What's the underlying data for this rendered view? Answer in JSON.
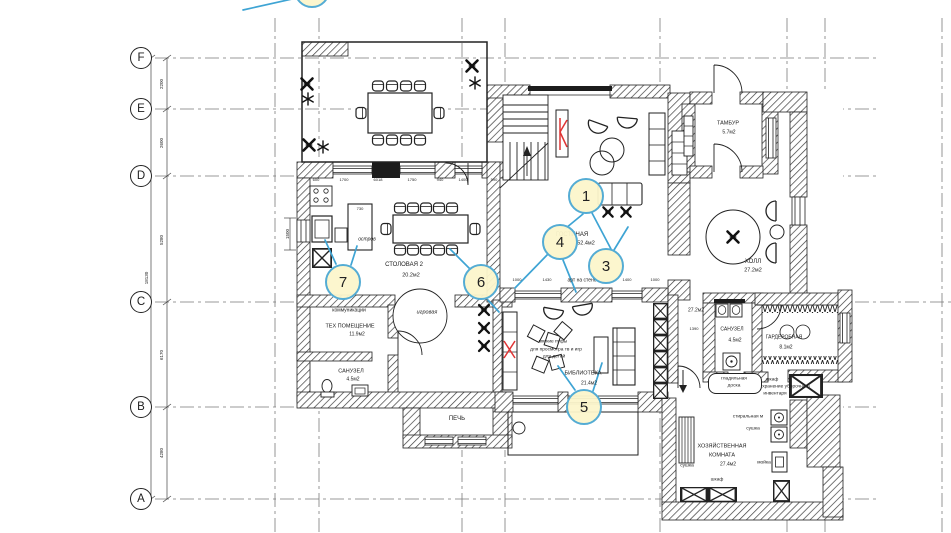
{
  "colors": {
    "leader": "#3EA4D4",
    "marker_fill": "#FCF5CB",
    "marker_border": "#54ACD4",
    "red_accent": "#E03434",
    "wall": "#222222"
  },
  "grid": {
    "bubbles": [
      "F",
      "E",
      "D",
      "C",
      "B",
      "A"
    ]
  },
  "dims": {
    "left": [
      "2200",
      "2600",
      "5280",
      "6170",
      "4280"
    ],
    "left_total": "18130",
    "kitchen_top": [
      "600",
      "1700",
      "6018",
      "1750",
      "940",
      "1400",
      "590"
    ],
    "living_bottom": [
      "1000",
      "1430",
      "1400",
      "1000"
    ],
    "island_width": "730",
    "stair_width": "1500",
    "hall_width": "1390"
  },
  "markers": {
    "m1": "1",
    "m2": "2",
    "m3": "3",
    "m4": "4",
    "m5": "5",
    "m6": "6",
    "m7": "7"
  },
  "rooms": {
    "dining2": {
      "name": "СТОЛОВАЯ 2",
      "area": "20.2м2"
    },
    "tech": {
      "name": "ТЕХ ПОМЕЩЕНИЕ",
      "area": "11.9м2"
    },
    "bath1": {
      "name": "САНУЗЕЛ",
      "area": "4.5м2"
    },
    "living": {
      "name": "ГОСТИНАЯ",
      "area": "52.4м2"
    },
    "hall": {
      "name": "ХОЛЛ",
      "area": "27.2м2",
      "area2": "27.2м2"
    },
    "tambour": {
      "name": "ТАМБУР",
      "area": "5.7м2"
    },
    "bath2": {
      "name": "САНУЗЕЛ",
      "area": "4.5м2"
    },
    "wardrobe": {
      "name": "ГАРДЕРОБНАЯ",
      "area": "8.1м2"
    },
    "library": {
      "name": "БИБЛИОТЕКА",
      "area": "21.4м2"
    },
    "utility": {
      "name1": "ХОЗЯЙСТВЕННАЯ",
      "name2": "КОМНАТА",
      "area": "27.4м2"
    },
    "stove": {
      "name": "ПЕЧЬ"
    },
    "playzone": {
      "name": "игровая"
    }
  },
  "annotations": {
    "communications": "коммуникации",
    "island": "остров",
    "art_wall": "арт на стене",
    "poufs1": "мягкие пуфы",
    "poufs2": "для просмотра тв и игр",
    "poufs3": "для детей",
    "ironing1": "гладильная",
    "ironing2": "доска",
    "closet1": "шкаф",
    "closet2": "хранение уборочного",
    "closet3": "инвентаря",
    "washer": "стиральная м",
    "dryer": "сушка",
    "dryer2": "сушка",
    "sink": "мойка",
    "wardrobe_small": "шкаф"
  }
}
